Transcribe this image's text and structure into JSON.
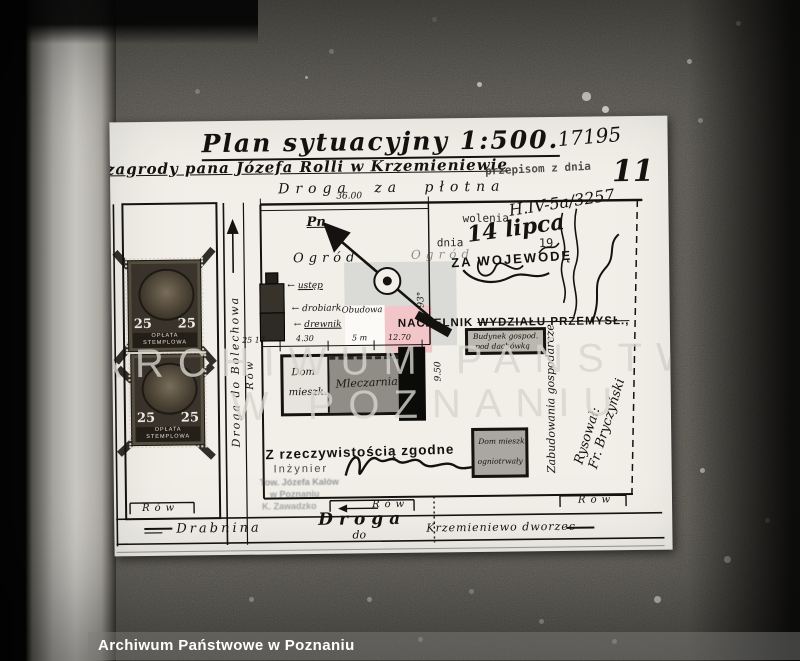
{
  "archive": {
    "caption": "Archiwum Państwowe w Poznaniu",
    "watermark_line1": "ARCHIWUM PAŃSTWOWE",
    "watermark_line2": "W POZNANIU"
  },
  "header": {
    "title": "Plan sytuacyjny 1:500.",
    "file_number": "17195",
    "subtitle": "zagrody pana Józefa Rolli w Krzemieniewie",
    "overprint": "przepisom z dnia",
    "page_number": "11"
  },
  "roads": {
    "top": "Droga za płotna",
    "left_vertical": "Droga do Bolechowa",
    "ditch": "Rów",
    "bottom_name": "Droga",
    "bottom_to": "do",
    "west_destination": "Drabnina",
    "east_destination": "Krzemieniewo dworzec"
  },
  "compass": {
    "north": "Pn"
  },
  "plan": {
    "garden_left": "Ogród",
    "garden_right": "Ogród",
    "note": "Obudowa",
    "outbuilding_labels": [
      "ustęp",
      "drobiark",
      "drewnik"
    ],
    "house_line1": "Dom",
    "house_line2": "mieszk.",
    "dairy": "Mleczarnia",
    "farm_building_line1": "Budynek gospod.",
    "farm_building_line2": "pod dachówką",
    "dwelling_line1": "Dom mieszk.",
    "dwelling_line2": "ogniotrwały",
    "vertical_note": "Zabudowania gospodarcze"
  },
  "dimensions": {
    "top_width": "36.00",
    "left_ticks": "25 17",
    "house": "4.30",
    "gap": "5 m",
    "yard": "12.70",
    "depth": "9.50",
    "angle": "93°"
  },
  "official": {
    "permit_fragment": "wolenia",
    "ref_number": "H.IV-5a/3257",
    "date_label": "dnia",
    "date_value": "14 lipca",
    "year": "19",
    "voivode_stamp": "ZA WOJEWODĘ",
    "naczelnik_1": "NACZELNIK",
    "naczelnik_2": "WYDZIAŁU PRZEMYSŁ.,",
    "conform": "Z rzeczywistością zgodne",
    "engineer": "Inżynier",
    "stamp_line1": "Tow. Józefa Kalów",
    "stamp_line2": "w Poznaniu",
    "stamp_line3": "K. Zawadzko",
    "drawn_by_1": "Rysował:",
    "drawn_by_2": "Fr. Bryczyński"
  },
  "revenue_stamp": {
    "value_left": "25",
    "value_right": "25",
    "label_line1": "OPŁATA",
    "label_line2": "STEMPLOWA"
  },
  "icons": {
    "arrow_left": "←"
  },
  "colors": {
    "paper": "#f1efe8",
    "watermark_pink": "#f2c6c9",
    "watermark_gray": "#dadad6"
  }
}
